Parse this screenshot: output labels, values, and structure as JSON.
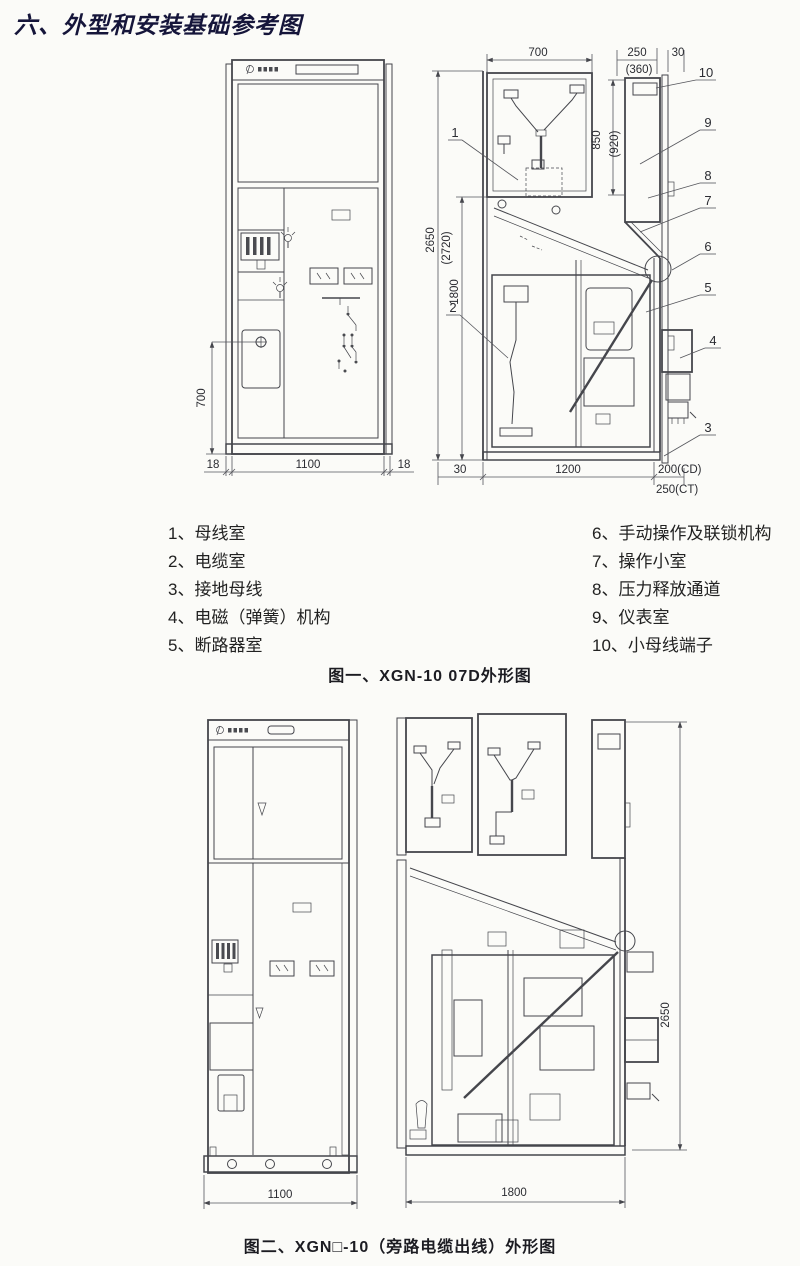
{
  "page": {
    "title": "六、外型和安装基础参考图"
  },
  "figure1": {
    "caption": "图一、XGN-10 07D外形图",
    "legend_left": [
      "1、母线室",
      "2、电缆室",
      "3、接地母线",
      "4、电磁（弹簧）机构",
      "5、断路器室"
    ],
    "legend_right": [
      "6、手动操作及联锁机构",
      "7、操作小室",
      "8、压力释放通道",
      "9、仪表室",
      "10、小母线端子"
    ],
    "front": {
      "dim_height": "700",
      "dim_rail_left": "18",
      "dim_width": "1100",
      "dim_rail_right": "18"
    },
    "side": {
      "dim_top_width": "700",
      "dim_panel_depth": "250",
      "dim_panel_depth_alt": "(360)",
      "dim_door": "30",
      "dim_panel_height": "850",
      "dim_panel_height_alt": "(920)",
      "dim_total_height": "2650",
      "dim_total_height_alt": "(2720)",
      "dim_lower_height": "1800",
      "dim_bottom_offset": "30",
      "dim_depth": "1200",
      "dim_rear_cd": "200(CD)",
      "dim_rear_ct": "250(CT)",
      "callouts": [
        "1",
        "2",
        "3",
        "4",
        "5",
        "6",
        "7",
        "8",
        "9",
        "10"
      ]
    }
  },
  "figure2": {
    "caption": "图二、XGN□-10（旁路电缆出线）外形图",
    "front": {
      "dim_width": "1100"
    },
    "side": {
      "dim_height": "2650",
      "dim_depth": "1800"
    }
  }
}
